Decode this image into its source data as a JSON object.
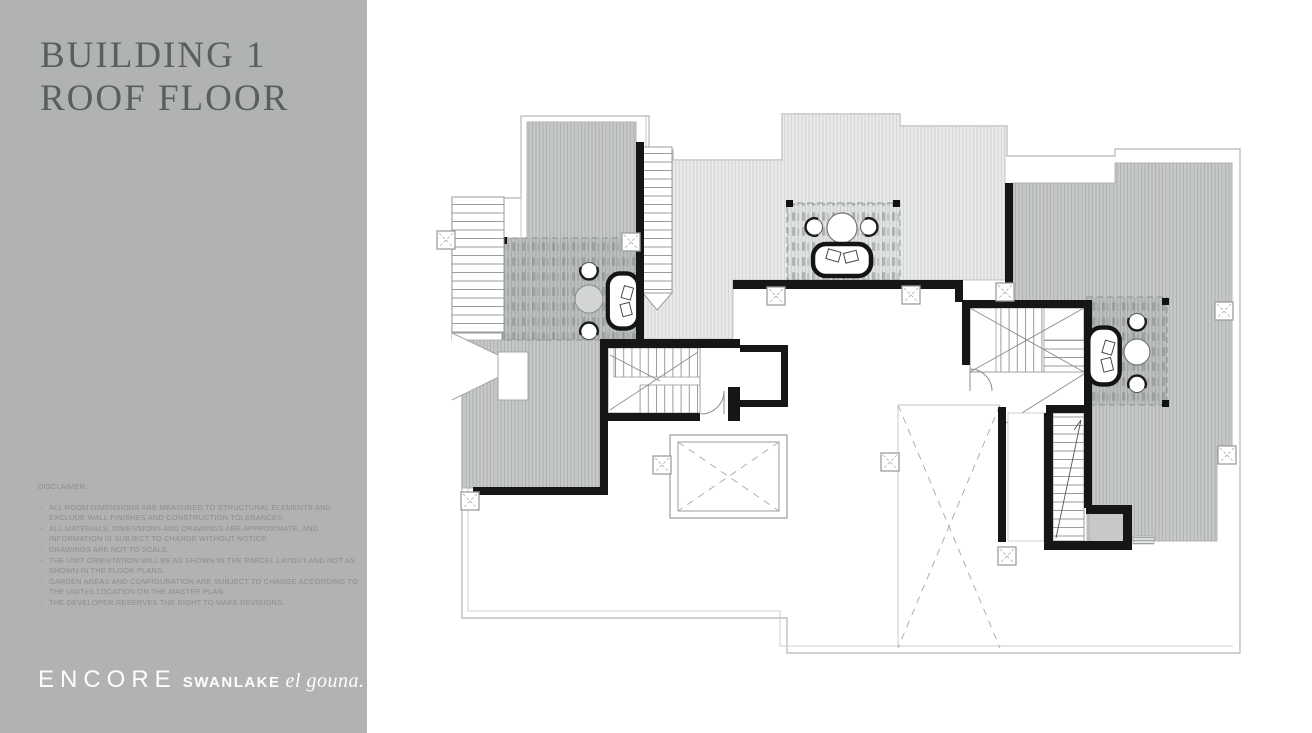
{
  "sidebar": {
    "title_line1": "BUILDING 1",
    "title_line2": "ROOF FLOOR",
    "disclaimer_heading": "DISCLAIMER:",
    "bullet": "-",
    "disclaimer_items": [
      "ALL ROOM DIMENSIONS ARE MEASURED TO STRUCTURAL ELEMENTS AND EXCLUDE WALL FINISHES AND CONSTRUCTION TOLERANCES.",
      "ALL MATERIALS, DIMENSIONS AND DRAWINGS ARE APPROXIMATE, AND INFORMATION IS SUBJECT TO CHANGE WITHOUT NOTICE.",
      "DRAWINGS ARE NOT TO SCALE.",
      "THE UNIT ORIENTATION WILL BE AS SHOWN IN THE PARCEL LAYOUT AND NOT AS SHOWN IN THE FLOOR PLANS.",
      "GARDEN AREAS AND CONFIGURATION ARE SUBJECT TO CHANGE ACCORDING TO THE UNIT±S LOCATION ON THE MASTER PLAN.",
      "THE DEVELOPER RESERVES THE RIGHT TO MAKE REVISIONS."
    ],
    "logo": {
      "part1": "ENCORE",
      "part2": "SWANLAKE",
      "part3": "el gouna."
    }
  },
  "plan": {
    "label": "Building 1 roof floor plan drawing",
    "colors": {
      "sidebar_bg": "#b1b2b2",
      "title_text": "#5b5e60",
      "wall": "#161616",
      "terrace_light": "#e8eae8",
      "terrace_medium": "#c6c9c7",
      "outline": "#b4b7b5"
    }
  }
}
